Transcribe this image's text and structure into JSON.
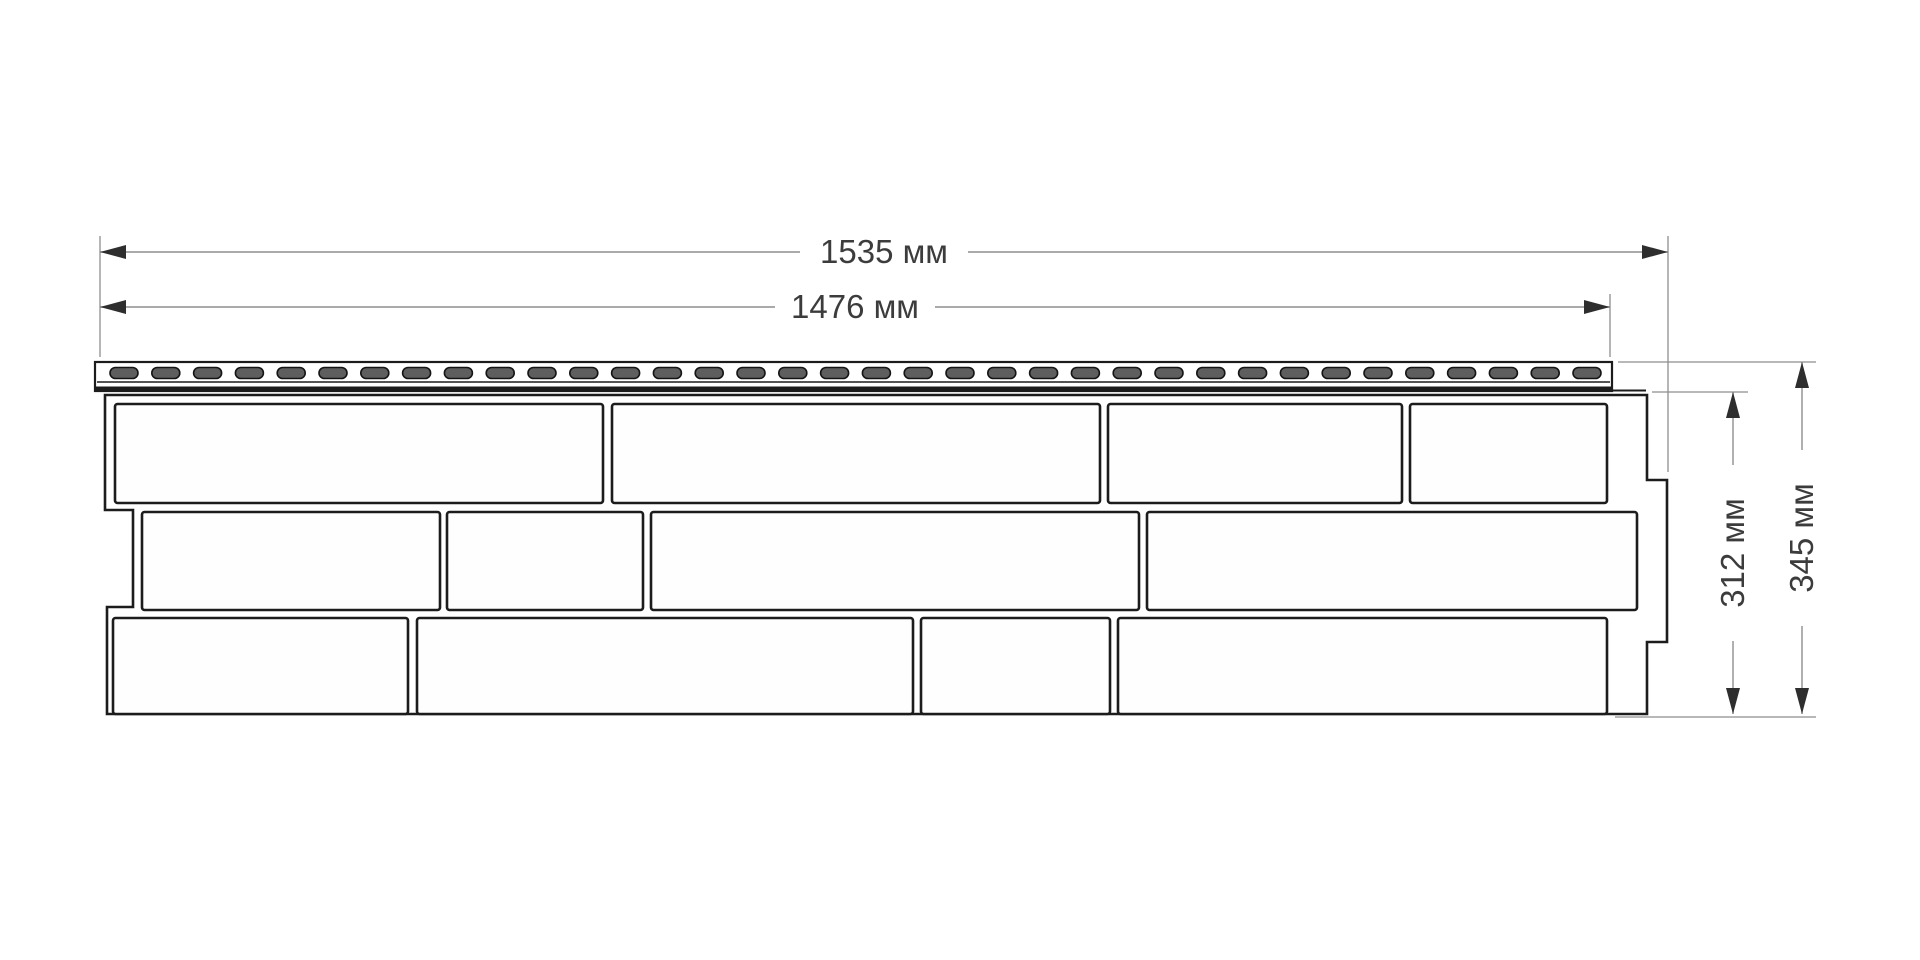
{
  "title": "facade-panel-dimension-drawing",
  "labels": {
    "width_total": "1535 мм",
    "width_useful": "1476 мм",
    "height_useful": "312 мм",
    "height_total": "345 мм"
  },
  "colors": {
    "background": "#ffffff",
    "line": "#1c1c1c",
    "dim_line": "#8e8e8e",
    "arrow": "#2e2e2e",
    "text": "#3c3c3c",
    "slot_fill": "#5e5e5e",
    "band": "#1b1b1b"
  },
  "drawing": {
    "strip": {
      "x": 95,
      "y": 362,
      "w": 1517,
      "h": 29,
      "inner_line_y": 382,
      "band_y": 386.5,
      "band_h": 3.8,
      "slot_x0": 110,
      "slot_pitch": 41.8,
      "slot_count": 36,
      "slot_w": 28,
      "slot_h": 11,
      "slot_y": 367.5,
      "tab_line": [
        1612,
        390.5,
        1646,
        390.5
      ]
    },
    "outline_points": "105,395 1647,395 1647,480 1667,480 1667,642 1647,642 1647,714 107,714 107,607 133,607 133,510 105,510",
    "rows": [
      {
        "y": 404,
        "h": 99,
        "bricks": [
          [
            115,
            488
          ],
          [
            612,
            488
          ],
          [
            1108,
            294
          ],
          [
            1410,
            197
          ]
        ]
      },
      {
        "y": 512,
        "h": 98,
        "bricks": [
          [
            142,
            298
          ],
          [
            447,
            196
          ],
          [
            651,
            488
          ],
          [
            1147,
            490
          ]
        ]
      },
      {
        "y": 618,
        "h": 96,
        "bricks": [
          [
            113,
            295
          ],
          [
            417,
            496
          ],
          [
            921,
            189
          ],
          [
            1118,
            489
          ]
        ]
      }
    ],
    "dim_segments": [
      [
        100,
        252,
        800,
        252
      ],
      [
        968,
        252,
        1668,
        252
      ],
      [
        100,
        307,
        775,
        307
      ],
      [
        935,
        307,
        1610,
        307
      ],
      [
        1733,
        392,
        1733,
        465
      ],
      [
        1733,
        641,
        1733,
        714
      ],
      [
        1802,
        362,
        1802,
        450
      ],
      [
        1802,
        626,
        1802,
        714
      ]
    ],
    "ext_segments": [
      [
        100,
        236,
        100,
        357
      ],
      [
        1668,
        236,
        1668,
        472
      ],
      [
        1610,
        294,
        1610,
        357
      ],
      [
        1652,
        392,
        1748,
        392
      ],
      [
        1618,
        362,
        1816,
        362
      ],
      [
        1615,
        717,
        1816,
        717
      ]
    ],
    "arrows": [
      [
        100,
        252,
        "l"
      ],
      [
        1668,
        252,
        "r"
      ],
      [
        100,
        307,
        "l"
      ],
      [
        1610,
        307,
        "r"
      ],
      [
        1733,
        392,
        "u"
      ],
      [
        1733,
        714,
        "d"
      ],
      [
        1802,
        362,
        "u"
      ],
      [
        1802,
        714,
        "d"
      ]
    ]
  }
}
